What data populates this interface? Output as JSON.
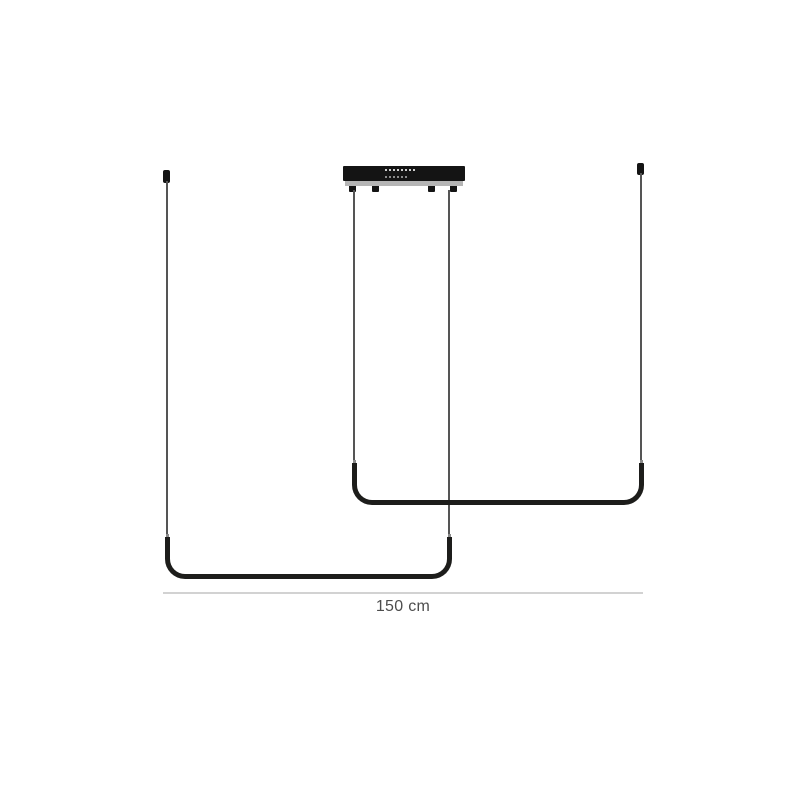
{
  "scene": {
    "subject": "black-linear-led-pendant-lamp",
    "dimension": {
      "label": "150 cm"
    }
  },
  "icons": {
    "canopy_indicator_dots": "led-driver-marking-dots"
  },
  "colors": {
    "background": "#ffffff",
    "bar": "#1d1d1b",
    "wire": "#555555",
    "canopy": "#141414",
    "canopy_strip": "#b5b5b5",
    "dimension_line": "#d2d2d2",
    "label_text": "#4d4d4d"
  }
}
